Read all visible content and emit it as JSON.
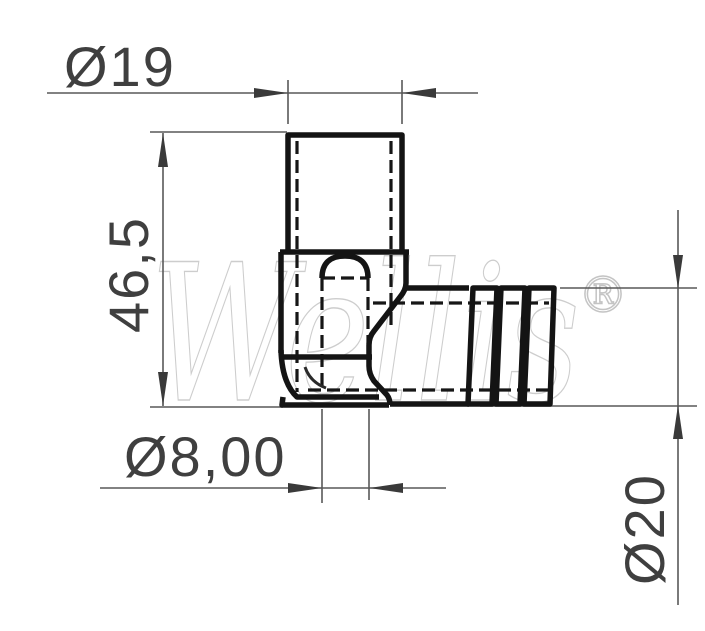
{
  "drawing": {
    "dimensions": {
      "top_diameter": "Ø19",
      "height": "46,5",
      "bore_diameter": "Ø8,00",
      "barb_diameter": "Ø20"
    },
    "watermark": {
      "text": "Wellis",
      "registered_mark": "®"
    },
    "colors": {
      "background": "#ffffff",
      "part_outline": "#161616",
      "dimension_lines": "#595959",
      "dimension_text": "#3f3f3f",
      "watermark": "#cccccc"
    }
  }
}
